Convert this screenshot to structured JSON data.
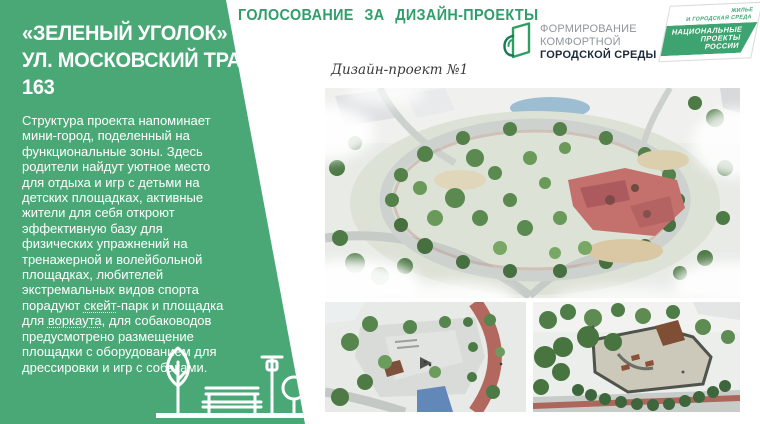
{
  "colors": {
    "sidebar_green": "#4aa877",
    "header_green": "#2f9e6a",
    "logo_green": "#2f9e62",
    "logo_dark": "#1c2b39",
    "logo_gray": "#90959a",
    "np_green": "#3da471"
  },
  "sidebar": {
    "title_line1": "«ЗЕЛЕНЫЙ УГОЛОК» ПО",
    "title_line2": "УЛ. МОСКОВСКИЙ ТРАКТ,",
    "title_line3": "163",
    "paragraph": {
      "part1": "Структура проекта напоминает мини-город, поделенный на функциональные зоны. Здесь родители найдут уютное место для отдыха и игр с детьми на детских площадках, активные жители для себя откроют эффективную базу для физических упражнений на тренажерной и волейбольной площадках, любителей экстремальных видов спорта порадуют ",
      "word1": "скейт",
      "part2": "-парк и площадка для ",
      "word2": "воркаута",
      "part3": ", для собаководов предусмотрено размещение площадки с оборудованием для дрессировки и игр с собаками."
    },
    "pictogram_icons": [
      "tree-icon",
      "bench-icon",
      "street-lamp-icon",
      "round-tree-icon"
    ]
  },
  "header": {
    "title": "ГОЛОСОВАНИЕ ЗА ДИЗАЙН-ПРОЕКТЫ"
  },
  "logos": {
    "fkgs": {
      "icon": "fkgs-sprout-house-icon",
      "line1": "ФОРМИРОВАНИЕ",
      "line2": "КОМФОРТНОЙ",
      "line3": "ГОРОДСКОЙ СРЕДЫ"
    },
    "national_projects": {
      "sector_line1": "ЖИЛЬЕ",
      "sector_line2": "И ГОРОДСКАЯ СРЕДА",
      "band_line1": "НАЦИОНАЛЬНЫЕ",
      "band_line2": "ПРОЕКТЫ",
      "band_line3": "РОССИИ"
    }
  },
  "main": {
    "project_label": "Дизайн-проект №1",
    "images": [
      "aerial-park-overview-render",
      "skate-plaza-render",
      "dog-park-render"
    ]
  }
}
